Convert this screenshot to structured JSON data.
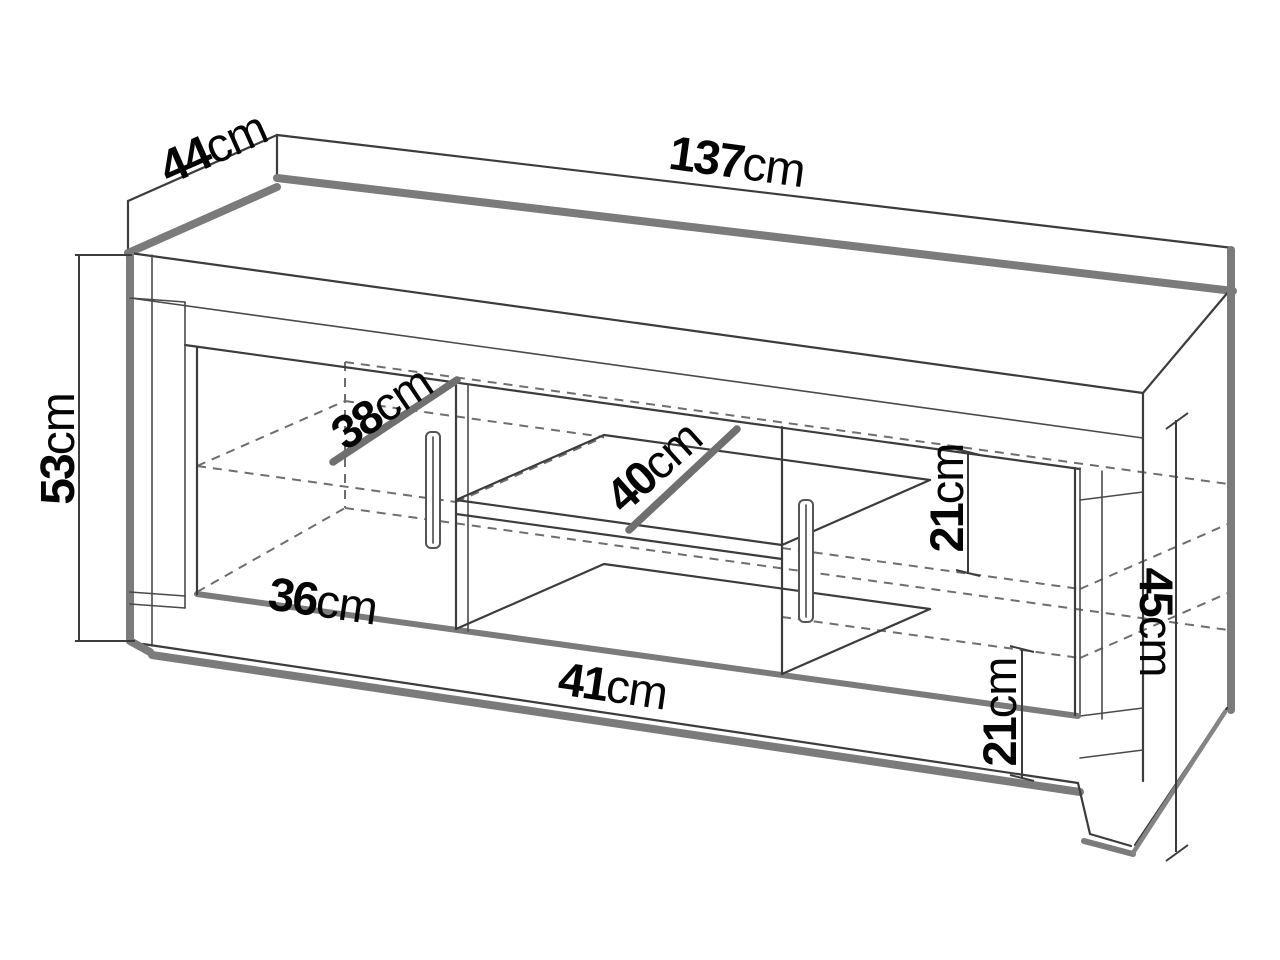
{
  "diagram": {
    "kind": "furniture-dimension-drawing",
    "subject": "tv-stand-sideboard",
    "line_color": "#3c3c3c",
    "shade_color": "#7b7b7b",
    "dimensions": {
      "d44": {
        "value": "44",
        "unit": "cm",
        "meaning": "top-depth"
      },
      "d137": {
        "value": "137",
        "unit": "cm",
        "meaning": "top-width"
      },
      "d53": {
        "value": "53",
        "unit": "cm",
        "meaning": "left-height"
      },
      "d38": {
        "value": "38",
        "unit": "cm",
        "meaning": "left-door-inner-width"
      },
      "d40": {
        "value": "40",
        "unit": "cm",
        "meaning": "middle-shelf-width"
      },
      "d36": {
        "value": "36",
        "unit": "cm",
        "meaning": "left-bottom-inner-width"
      },
      "d41": {
        "value": "41",
        "unit": "cm",
        "meaning": "middle-bottom-width"
      },
      "d21a": {
        "value": "21",
        "unit": "cm",
        "meaning": "right-upper-shelf-gap"
      },
      "d21b": {
        "value": "21",
        "unit": "cm",
        "meaning": "right-lower-shelf-gap"
      },
      "d45": {
        "value": "45",
        "unit": "cm",
        "meaning": "right-side-height"
      }
    }
  }
}
